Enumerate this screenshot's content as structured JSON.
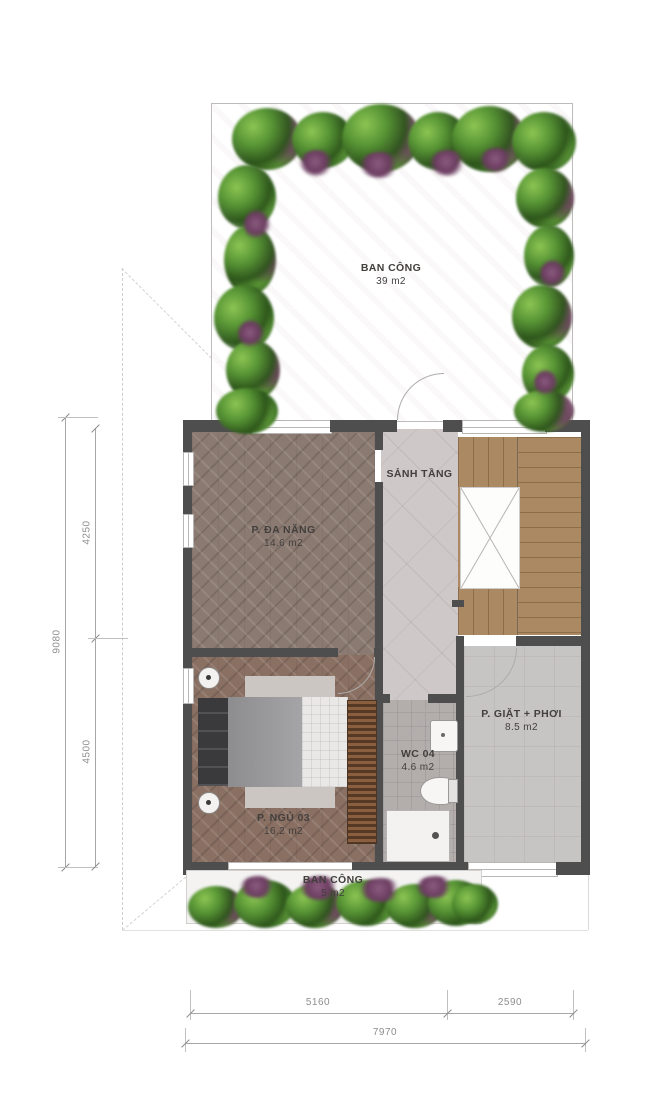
{
  "plan_title": "floor-plan-upper-level",
  "rooms": {
    "balcony_top": {
      "name": "BAN CÔNG",
      "area": "39 m2"
    },
    "hall": {
      "name": "SẢNH TẦNG",
      "area": ""
    },
    "multi": {
      "name": "P. ĐA NĂNG",
      "area": "14.6 m2"
    },
    "bedroom": {
      "name": "P. NGỦ 03",
      "area": "16.2 m2"
    },
    "wc": {
      "name": "WC 04",
      "area": "4.6 m2"
    },
    "laundry": {
      "name": "P. GIẶT + PHƠI",
      "area": "8.5 m2"
    },
    "balcony_bottom": {
      "name": "BAN CÔNG",
      "area": "5 m2"
    }
  },
  "dimensions": {
    "left_total": "9080",
    "left_segment_top": "4250",
    "left_segment_bottom": "4500",
    "bottom_segment_left": "5160",
    "bottom_segment_right": "2590",
    "bottom_total": "7970"
  },
  "colors": {
    "wall": "#4f4e4e",
    "wood_floor": "#8b7a71",
    "bedroom_floor": "#8a7063",
    "stair_wood": "#ab8a63",
    "hall_floor": "#cfc8c8",
    "balcony_tile": "#c9c7c6",
    "laundry_floor": "#c7c5c4",
    "wc_floor": "#b3aeac",
    "plant_green": "#5a9637",
    "plant_purple": "#7c5273",
    "dimension_text": "#8f8d8c"
  }
}
